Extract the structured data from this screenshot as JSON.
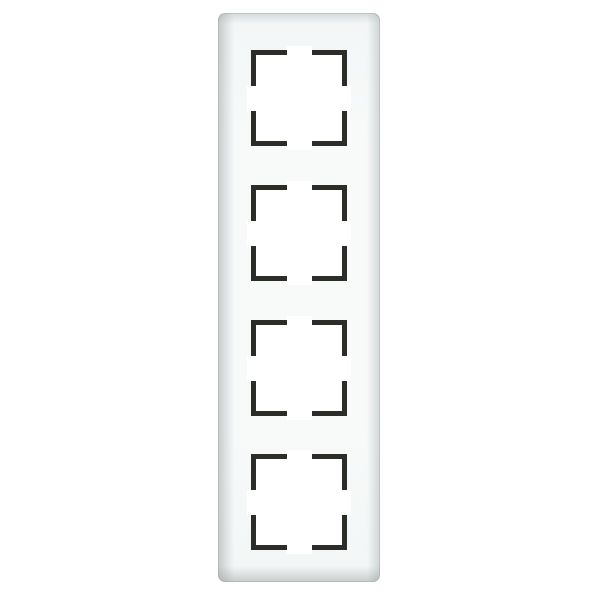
{
  "product_photo": {
    "subject": "Vertical 4-gang white glass light-switch cover frame with four square module openings",
    "opening_count": 4,
    "openings": [
      {
        "position": 1
      },
      {
        "position": 2
      },
      {
        "position": 3
      },
      {
        "position": 4
      }
    ],
    "colors": {
      "background": "#ffffff",
      "glass_body": "#f3f6f6",
      "glass_highlight": "#f8fafa",
      "glass_edge": "#dce0e0",
      "opening_fill": "#ffffff",
      "bracket": "#2c2c29"
    }
  },
  "theme": {
    "bg": "#ffffff",
    "glass-body": "#f3f6f6",
    "glass-highlight": "#f8fafa",
    "glass-edge": "#dce0e0",
    "opening-fill": "#ffffff",
    "bracket": "#2c2c29"
  }
}
